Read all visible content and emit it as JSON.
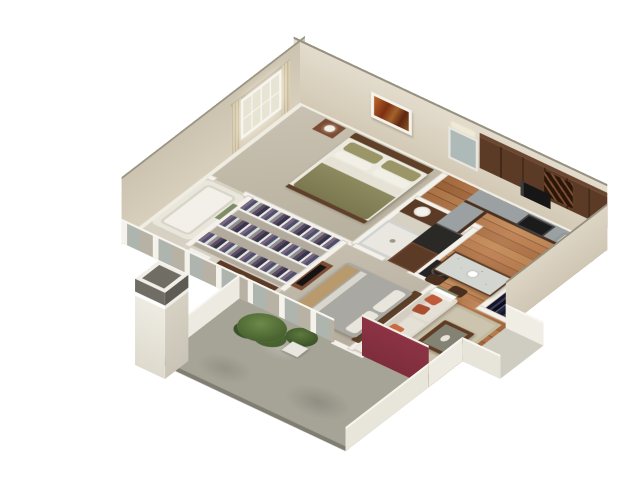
{
  "scene": {
    "type": "3d-isometric-floor-plan-render",
    "description": "One-bedroom-plus-den apartment 3D cutaway floor plan on white background",
    "background": "#ffffff"
  },
  "palette": {
    "wallFace": "#d8cfbd",
    "wallFaceLight": "#e3dccd",
    "wallTopEdge": "#97917f",
    "trim": "#f3f1ea",
    "lowWallFace": "#b8b2a4",
    "maroonWall": "#7e2d3c",
    "wood": "#a96f42",
    "carpetBed1": "#c9c2b2",
    "carpetBed2": "#c6bfb0",
    "carpetCloset": "#b2ab9d",
    "tile": "#d7d1c4",
    "concrete": "#a6a397",
    "concreteEdge": "#807d72",
    "landing": "#cfccc2",
    "cabinetWood": "#5c3b26",
    "cabinetWoodLight": "#7b4c33",
    "granite": "#9ba1a3",
    "islandTop": "#d3d6d0",
    "appliance": "#1b1b1b",
    "fridge": "#2b2926",
    "sofa": "#ded9cd",
    "sofaBack": "#d3cec1",
    "pillowRust": "#bf5a3a",
    "pillowRustDark": "#a94e30",
    "rug": "#ccc4ae",
    "rugBorder": "#c2b99f",
    "tableWood": "#5f3d24",
    "headboardWood": "#5f4129",
    "duvetOlive": "#8d8a60",
    "pillowOlive": "#9a9668",
    "duvetGray": "#a9a8a2",
    "throwTan": "#b89a6c",
    "linenWhite": "#eceadf",
    "porcelain": "#f4f2ec",
    "mirror": "#aebab8",
    "artOrange": "#b4622a",
    "plantGreen": "#49622f",
    "plantGreenLight": "#6d8a4a",
    "towelGreen": "#7d8d66",
    "lampShade": "#f1efe8",
    "glass": "#e8e4d4",
    "curtain": "#d8cdb2",
    "columnCap": "#6f6d64"
  },
  "rooms": [
    {
      "id": "bedroom-1",
      "label": "Bedroom 1"
    },
    {
      "id": "bathroom-2",
      "label": "Bathroom"
    },
    {
      "id": "kitchen",
      "label": "Kitchen"
    },
    {
      "id": "dining",
      "label": "Dining / island area"
    },
    {
      "id": "master-closet",
      "label": "Walk-in closet"
    },
    {
      "id": "bathroom-1",
      "label": "Bathroom with tub"
    },
    {
      "id": "bedroom-2",
      "label": "Bedroom 2"
    },
    {
      "id": "living-room",
      "label": "Living room"
    },
    {
      "id": "entry",
      "label": "Entry"
    },
    {
      "id": "patio",
      "label": "Patio"
    }
  ],
  "furniture": {
    "bedroom-1": [
      "queen-bed-olive-bedding",
      "nightstand",
      "table-lamp",
      "wall-art",
      "window-with-curtains"
    ],
    "bathroom-2": [
      "vanity-sink",
      "mirror-with-light",
      "toilet",
      "shower-stall",
      "towel-shelf"
    ],
    "kitchen": [
      "l-shaped-counter",
      "upper-cabinets",
      "wine-rack",
      "microwave",
      "stove",
      "double-sink",
      "refrigerator",
      "pantry-cabinet",
      "washer"
    ],
    "dining": [
      "granite-island",
      "bar-stool",
      "bar-stool"
    ],
    "master-closet": [
      "clothes-rack-row",
      "clothes-rack-row",
      "clothes-rack-row"
    ],
    "bathroom-1": [
      "bathtub",
      "green-towels",
      "toilet",
      "vanity-sink"
    ],
    "bedroom-2": [
      "queen-bed-gray-bedding",
      "dresser-with-tv"
    ],
    "living-room": [
      "sofa-with-rust-pillows",
      "area-rug",
      "coffee-table",
      "tv-on-stand",
      "side-table-with-lamp",
      "linen-shelf"
    ],
    "entry": [
      "coat-closet-dark-clothes",
      "landing-walkway"
    ],
    "patio": [
      "concrete-slab",
      "square-column",
      "potted-plants",
      "planter-box",
      "maroon-accent-wall"
    ]
  }
}
